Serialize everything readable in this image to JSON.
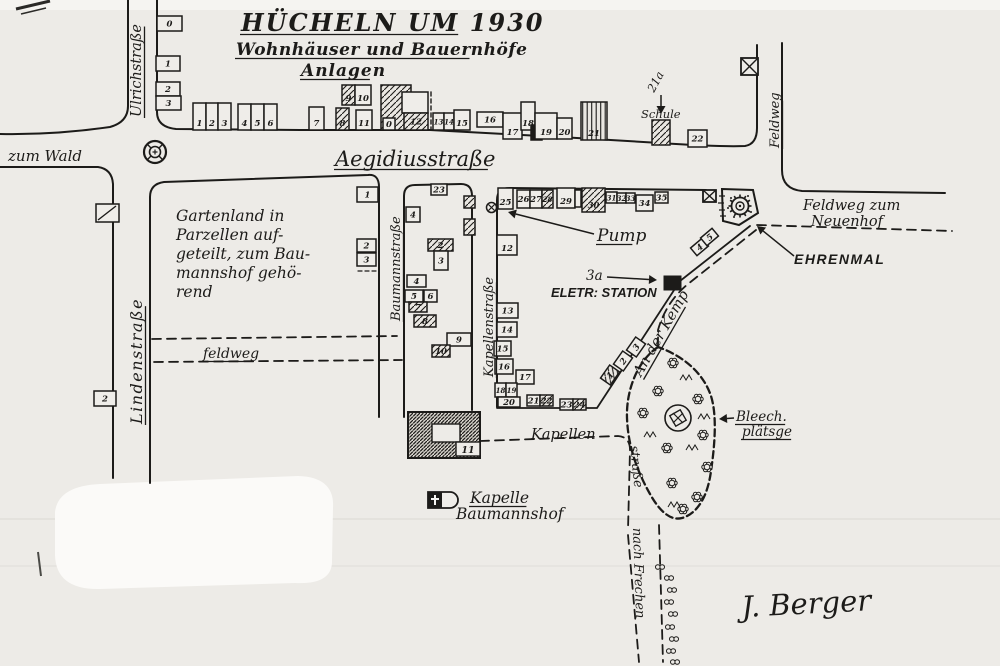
{
  "meta": {
    "document_type": "scanned hand-drawn village map",
    "ink": "#1c1b19",
    "paper": "#edebe7",
    "paper_light": "#f5f4f1",
    "blob": "#fbfaf8",
    "building_fill": "#efede9"
  },
  "title": {
    "line1": "HÜCHELN UM 1930",
    "line2": "Wohnhäuser und Bauernhöfe",
    "line3": "Anlagen"
  },
  "signature": "J. Berger",
  "labels": [
    {
      "id": "title-line1",
      "t": "HÜCHELN UM 1930",
      "x": 241,
      "y": 31,
      "s": 24,
      "u": 1,
      "ls": 2,
      "c": "handb"
    },
    {
      "id": "title-line2",
      "t": "Wohnhäuser und Bauernhöfe",
      "x": 236,
      "y": 55,
      "s": 17,
      "u": 1,
      "ls": 0.5,
      "c": "handb"
    },
    {
      "id": "title-line3",
      "t": "Anlagen",
      "x": 301,
      "y": 76,
      "s": 17,
      "u": 1,
      "ls": 1,
      "c": "handb"
    },
    {
      "id": "street-ulrichstrasse",
      "t": "Ulrichstraße",
      "x": 141,
      "y": 117,
      "s": 14.5,
      "r": -90,
      "u": 1
    },
    {
      "id": "street-zum-wald",
      "t": "zum Wald",
      "x": 8,
      "y": 161,
      "s": 15
    },
    {
      "id": "street-aegidiusstrasse",
      "t": "Aegidiusstraße",
      "x": 335,
      "y": 166,
      "s": 21,
      "u": 1
    },
    {
      "id": "street-lindenstrasse",
      "t": "Lindenstraße",
      "x": 142,
      "y": 424,
      "s": 16,
      "u": 1,
      "r": -90,
      "ls": 1.5
    },
    {
      "id": "street-baumannstrasse",
      "t": "Baumannstraße",
      "x": 400,
      "y": 321,
      "s": 13,
      "u": 1,
      "r": -90
    },
    {
      "id": "street-kapellenstrasse",
      "t": "Kapellenstraße",
      "x": 493,
      "y": 377,
      "s": 13,
      "u": 1,
      "r": -90
    },
    {
      "id": "street-feldweg-right",
      "t": "Feldweg",
      "x": 779,
      "y": 148,
      "s": 13,
      "u": 1,
      "r": -90
    },
    {
      "id": "street-feldweg-dashed",
      "t": "feldweg",
      "x": 203,
      "y": 358,
      "s": 14,
      "u": 1
    },
    {
      "id": "gartenland-line1",
      "t": "Gartenland in",
      "x": 176,
      "y": 221,
      "s": 15.5
    },
    {
      "id": "gartenland-line2",
      "t": "Parzellen auf-",
      "x": 176,
      "y": 240,
      "s": 15.5
    },
    {
      "id": "gartenland-line3",
      "t": "geteilt, zum Bau-",
      "x": 176,
      "y": 259,
      "s": 15.5
    },
    {
      "id": "gartenland-line4",
      "t": "mannshof gehö-",
      "x": 176,
      "y": 278,
      "s": 15.5
    },
    {
      "id": "gartenland-line5",
      "t": "rend",
      "x": 176,
      "y": 297,
      "s": 15.5
    },
    {
      "id": "label-pump",
      "t": "Pump",
      "x": 597,
      "y": 241,
      "s": 17,
      "u": 1
    },
    {
      "id": "label-3a",
      "t": "3a",
      "x": 586,
      "y": 280,
      "s": 13.5
    },
    {
      "id": "label-eletr-station",
      "t": "ELETR: STATION",
      "x": 551,
      "y": 297,
      "s": 13,
      "c": "block"
    },
    {
      "id": "label-ehrenmal",
      "t": "EHRENMAL",
      "x": 794,
      "y": 264,
      "s": 14,
      "c": "block",
      "ls": 1.5
    },
    {
      "id": "label-feldweg-zum",
      "t": "Feldweg zum",
      "x": 803,
      "y": 210,
      "s": 14.5
    },
    {
      "id": "label-neuenhof",
      "t": "Neuenhof",
      "x": 811,
      "y": 226,
      "s": 14.5
    },
    {
      "id": "street-an-der-kemp",
      "t": "An der Kemp",
      "x": 641,
      "y": 377,
      "s": 14.5,
      "r": -60,
      "u": 1
    },
    {
      "id": "label-bleech-line1",
      "t": "Bleech.",
      "x": 736,
      "y": 421,
      "s": 13.5,
      "u": 1
    },
    {
      "id": "label-bleech-line2",
      "t": "plätsge",
      "x": 742,
      "y": 436,
      "s": 13.5,
      "u": 1
    },
    {
      "id": "street-kapellen",
      "t": "Kapellen",
      "x": 531,
      "y": 439,
      "s": 14.5
    },
    {
      "id": "street-strasse",
      "t": "straße",
      "x": 630,
      "y": 446,
      "s": 13,
      "r": 84
    },
    {
      "id": "street-nach-frechen",
      "t": "nach Frechen",
      "x": 633,
      "y": 528,
      "s": 13,
      "r": 88
    },
    {
      "id": "label-kapelle",
      "t": "Kapelle",
      "x": 470,
      "y": 503,
      "s": 15.5,
      "u": 1
    },
    {
      "id": "label-baumannshof",
      "t": "Baumannshof",
      "x": 456,
      "y": 519,
      "s": 15.5
    },
    {
      "id": "label-schule",
      "t": "Schule",
      "x": 641,
      "y": 118,
      "s": 11.5
    },
    {
      "id": "label-21a",
      "t": "21a",
      "x": 654,
      "y": 93,
      "s": 11.5,
      "r": -62
    },
    {
      "id": "signature",
      "t": "J. Berger",
      "x": 742,
      "y": 617,
      "s": 29,
      "c": "sig",
      "r": -3
    }
  ],
  "roads": [
    {
      "name": "road-ulrichstrasse-west",
      "d": "M128,0 L128,106 Q128,122 110,127 Q55,135 0,134",
      "dash": 0,
      "w": 2
    },
    {
      "name": "road-ulrich-aegidius-north-feldweg",
      "d": "M157,0 L157,112 Q157,127 176,129 L300,130 L430,130 L560,137 L660,143 Q720,147 745,146 Q757,144 757,128 L757,45",
      "dash": 0,
      "w": 2
    },
    {
      "name": "road-zum-wald-south",
      "d": "M0,167 L98,167 Q112,169 113,184 L113,478",
      "dash": 0,
      "w": 2
    },
    {
      "name": "road-linden-east-aegidius-south-baumann-west",
      "d": "M150,483 L150,197 Q150,184 164,182 L368,175 Q379,174 379,187 L379,417",
      "dash": 0,
      "w": 2
    },
    {
      "name": "road-baumann-east-block-outline",
      "d": "M404,417 L404,196 Q404,185 415,185 L461,184 Q472,184 472,196 L472,410",
      "dash": 0,
      "w": 2
    },
    {
      "name": "road-kapellen-west-aegidius-south",
      "d": "M497,407 L497,200 Q497,188 510,188 L706,190",
      "dash": 0,
      "w": 2
    },
    {
      "name": "road-feldweg-east",
      "d": "M782,43 L782,170 Q782,189 802,191 L945,193",
      "dash": 0,
      "w": 2
    },
    {
      "name": "road-neuenhof-south-dashed",
      "d": "M757,225 L952,231",
      "dash": 1,
      "w": 1.8
    },
    {
      "name": "road-an-der-kemp-northwest",
      "d": "M750,226 L680,281 L597,408 L497,408",
      "dash": 0,
      "w": 1.8
    },
    {
      "name": "road-an-der-kemp-southeast-dashed",
      "d": "M756,230 L688,284 Q666,302 658,330 L658,345",
      "dash": 1,
      "w": 1.8
    },
    {
      "name": "bleichplatz-outline-dashed",
      "d": "M658,347 C637,361 626,391 627,418 C628,446 637,471 650,494 C660,512 671,521 682,518 C699,513 708,494 711,471 C715,444 717,415 711,396 C704,375 686,357 658,347 Z",
      "dash": 2,
      "w": 2.3
    },
    {
      "name": "road-kapellen-dashed",
      "d": "M480,441 L618,436 Q630,437 630,450 L628,530",
      "dash": 1,
      "w": 1.8
    },
    {
      "name": "road-nach-frechen-west-dashed",
      "d": "M628,535 L639,662",
      "dash": 1,
      "w": 1.8
    },
    {
      "name": "road-nach-frechen-east-dashed",
      "d": "M659,525 L663,662",
      "dash": 1,
      "w": 1.8
    },
    {
      "name": "road-feldweg-north-dashed",
      "d": "M152,339 L397,336",
      "dash": 1,
      "w": 1.8
    },
    {
      "name": "road-feldweg-south-dashed",
      "d": "M154,362 L402,360",
      "dash": 1,
      "w": 1.8
    },
    {
      "name": "farm-boundary-dashed",
      "d": "M431,92 L431,130",
      "dash": 3,
      "w": 1.4
    },
    {
      "name": "baumann-plot-dashed",
      "d": "M358,271 L377,271",
      "dash": 3,
      "w": 1.2
    }
  ],
  "buildings": [
    [
      157,
      16,
      25,
      15,
      "0",
      "p"
    ],
    [
      156,
      56,
      24,
      15,
      "1",
      "p"
    ],
    [
      156,
      82,
      24,
      14,
      "2",
      "p"
    ],
    [
      156,
      96,
      25,
      14,
      "3",
      "p"
    ],
    [
      193,
      103,
      13,
      27,
      "1",
      "p"
    ],
    [
      206,
      103,
      12,
      27,
      "2",
      "p"
    ],
    [
      218,
      103,
      13,
      27,
      "3",
      "p"
    ],
    [
      238,
      104,
      13,
      26,
      "4",
      "p"
    ],
    [
      251,
      104,
      13,
      26,
      "5",
      "p"
    ],
    [
      264,
      104,
      13,
      26,
      "6",
      "p"
    ],
    [
      309,
      107,
      15,
      23,
      "7",
      "p"
    ],
    [
      336,
      108,
      13,
      22,
      "8",
      "h"
    ],
    [
      342,
      85,
      13,
      20,
      "9",
      "h"
    ],
    [
      355,
      85,
      16,
      20,
      "10",
      "p"
    ],
    [
      356,
      110,
      16,
      20,
      "11",
      "p"
    ],
    [
      381,
      85,
      30,
      45,
      "",
      "h"
    ],
    [
      402,
      92,
      26,
      21,
      "",
      "p"
    ],
    [
      383,
      118,
      12,
      12,
      "0",
      "p"
    ],
    [
      404,
      113,
      24,
      17,
      "12",
      "h"
    ],
    [
      433,
      113,
      11,
      17,
      "13",
      "p"
    ],
    [
      444,
      113,
      10,
      17,
      "14",
      "p"
    ],
    [
      454,
      110,
      16,
      20,
      "15",
      "p"
    ],
    [
      477,
      112,
      26,
      15,
      "16",
      "p"
    ],
    [
      503,
      113,
      19,
      26,
      "17",
      "p"
    ],
    [
      521,
      102,
      14,
      28,
      "18",
      "p"
    ],
    [
      531,
      125,
      11,
      15,
      "",
      "s"
    ],
    [
      535,
      113,
      22,
      26,
      "19",
      "p"
    ],
    [
      557,
      118,
      15,
      21,
      "20",
      "p"
    ],
    [
      581,
      102,
      26,
      38,
      "21",
      "v"
    ],
    [
      652,
      120,
      18,
      25,
      "",
      "h"
    ],
    [
      688,
      130,
      19,
      17,
      "22",
      "p"
    ],
    [
      498,
      188,
      15,
      21,
      "25",
      "p"
    ],
    [
      517,
      190,
      13,
      18,
      "26",
      "p"
    ],
    [
      530,
      190,
      12,
      18,
      "27",
      "p"
    ],
    [
      542,
      190,
      11,
      18,
      "28",
      "h"
    ],
    [
      557,
      188,
      18,
      20,
      "29",
      "p"
    ],
    [
      575,
      190,
      6,
      17,
      "",
      "p"
    ],
    [
      582,
      188,
      23,
      24,
      "30",
      "h"
    ],
    [
      606,
      192,
      11,
      11,
      "31",
      "p"
    ],
    [
      617,
      193,
      9,
      10,
      "32",
      "p"
    ],
    [
      626,
      193,
      9,
      10,
      "33",
      "p"
    ],
    [
      636,
      195,
      17,
      16,
      "34",
      "p"
    ],
    [
      655,
      192,
      13,
      11,
      "35",
      "p"
    ],
    [
      431,
      184,
      16,
      11,
      "23",
      "p"
    ],
    [
      464,
      196,
      11,
      12,
      "",
      "h"
    ],
    [
      464,
      219,
      11,
      16,
      "",
      "h"
    ],
    [
      406,
      207,
      14,
      15,
      "4",
      "p"
    ],
    [
      428,
      239,
      25,
      12,
      "2",
      "h"
    ],
    [
      434,
      251,
      14,
      19,
      "3",
      "p"
    ],
    [
      407,
      275,
      19,
      12,
      "4",
      "p"
    ],
    [
      405,
      290,
      18,
      12,
      "5",
      "p"
    ],
    [
      424,
      290,
      13,
      12,
      "6",
      "p"
    ],
    [
      409,
      302,
      18,
      10,
      "7",
      "h"
    ],
    [
      414,
      315,
      22,
      12,
      "8",
      "h"
    ],
    [
      447,
      333,
      24,
      13,
      "9",
      "p"
    ],
    [
      432,
      345,
      18,
      12,
      "10",
      "h"
    ],
    [
      357,
      187,
      21,
      15,
      "1",
      "p"
    ],
    [
      357,
      239,
      19,
      13,
      "2",
      "p"
    ],
    [
      357,
      253,
      19,
      13,
      "3",
      "p"
    ],
    [
      96,
      204,
      23,
      18,
      "",
      "x"
    ],
    [
      94,
      391,
      22,
      15,
      "2",
      "p"
    ],
    [
      497,
      235,
      20,
      20,
      "12",
      "p"
    ],
    [
      497,
      303,
      21,
      15,
      "13",
      "p"
    ],
    [
      497,
      322,
      20,
      15,
      "14",
      "p"
    ],
    [
      494,
      341,
      17,
      15,
      "15",
      "p"
    ],
    [
      495,
      359,
      18,
      15,
      "16",
      "p"
    ],
    [
      516,
      370,
      18,
      14,
      "17",
      "p"
    ],
    [
      495,
      383,
      11,
      14,
      "18",
      "p"
    ],
    [
      506,
      383,
      11,
      14,
      "19",
      "p"
    ],
    [
      498,
      397,
      22,
      10,
      "20",
      "p"
    ],
    [
      527,
      395,
      13,
      11,
      "21",
      "p"
    ],
    [
      540,
      395,
      13,
      11,
      "22",
      "h"
    ],
    [
      560,
      399,
      13,
      11,
      "23",
      "p"
    ],
    [
      573,
      399,
      13,
      11,
      "24",
      "h"
    ],
    [
      602,
      369,
      16,
      12,
      "1",
      "h",
      -55
    ],
    [
      615,
      355,
      16,
      12,
      "2",
      "p",
      -55
    ],
    [
      628,
      341,
      16,
      12,
      "3",
      "p",
      -55
    ],
    [
      692,
      242,
      15,
      10,
      "4",
      "p",
      -40
    ],
    [
      702,
      232,
      15,
      10,
      "5",
      "p",
      -40
    ]
  ],
  "symbols": [
    {
      "t": "crossring",
      "x": 155,
      "y": 152,
      "name": "crossroads-cross-symbol"
    },
    {
      "t": "pumpx",
      "x": 491.5,
      "y": 207.5,
      "name": "pump-symbol"
    },
    {
      "t": "boxx",
      "x": 741,
      "y": 58,
      "w": 17,
      "h": 17,
      "name": "feldweg-cross-box-symbol"
    },
    {
      "t": "boxx",
      "x": 703,
      "y": 190,
      "w": 13,
      "h": 12,
      "name": "ehrenmal-cross-box-symbol"
    },
    {
      "t": "plot",
      "d": "M722,189 L753,190 L758,213 L739,225 L723,221 Z",
      "name": "ehrenmal-plot"
    },
    {
      "t": "gear",
      "x": 740,
      "y": 206,
      "name": "ehrenmal-monument-symbol"
    },
    {
      "t": "rect",
      "x": 664,
      "y": 276,
      "w": 17,
      "h": 14,
      "name": "eletr-station-building"
    },
    {
      "t": "c11",
      "name": "building-11-baumannshof"
    },
    {
      "t": "chapel",
      "x": 428,
      "y": 492,
      "name": "kapelle-symbol"
    },
    {
      "t": "bleichcenter",
      "x": 678,
      "y": 418,
      "name": "bleichplatz-center-symbol"
    }
  ],
  "arrows": [
    {
      "x1": 594,
      "y1": 234,
      "x2": 508,
      "y2": 212,
      "name": "pump-arrow"
    },
    {
      "x1": 607,
      "y1": 277,
      "x2": 657,
      "y2": 280,
      "name": "station-arrow"
    },
    {
      "x1": 794,
      "y1": 256,
      "x2": 757,
      "y2": 226,
      "name": "ehrenmal-arrow"
    },
    {
      "x1": 734,
      "y1": 418,
      "x2": 719,
      "y2": 419,
      "name": "bleech-arrow"
    },
    {
      "x1": 661,
      "y1": 95,
      "x2": 661,
      "y2": 114,
      "name": "schule-arrow"
    }
  ],
  "trees": [
    [
      673,
      363
    ],
    [
      658,
      391
    ],
    [
      698,
      399
    ],
    [
      643,
      413
    ],
    [
      703,
      435
    ],
    [
      667,
      448
    ],
    [
      707,
      467
    ],
    [
      672,
      483
    ],
    [
      697,
      497
    ],
    [
      683,
      509
    ]
  ],
  "bushes": [
    [
      660,
      567
    ],
    [
      669,
      578
    ],
    [
      672,
      590
    ],
    [
      669,
      602
    ],
    [
      673,
      614
    ],
    [
      670,
      627
    ],
    [
      674,
      639
    ],
    [
      671,
      651
    ],
    [
      675,
      662
    ]
  ],
  "zigzags": [
    [
      688,
      377
    ],
    [
      694,
      447
    ],
    [
      652,
      434
    ],
    [
      676,
      504
    ],
    [
      706,
      416
    ]
  ],
  "paper": {
    "blob": "M55,512 Q58,486 100,484 L298,476 Q335,477 333,508 L332,560 Q333,585 295,583 L100,589 Q56,590 55,555 Z",
    "scanline1_y": 519,
    "scanline2_y": 566,
    "corner_mark1": "M16,9 L50,1",
    "corner_mark2": "M21,14 L46,8",
    "scratch": "M38,552 L41,576"
  }
}
